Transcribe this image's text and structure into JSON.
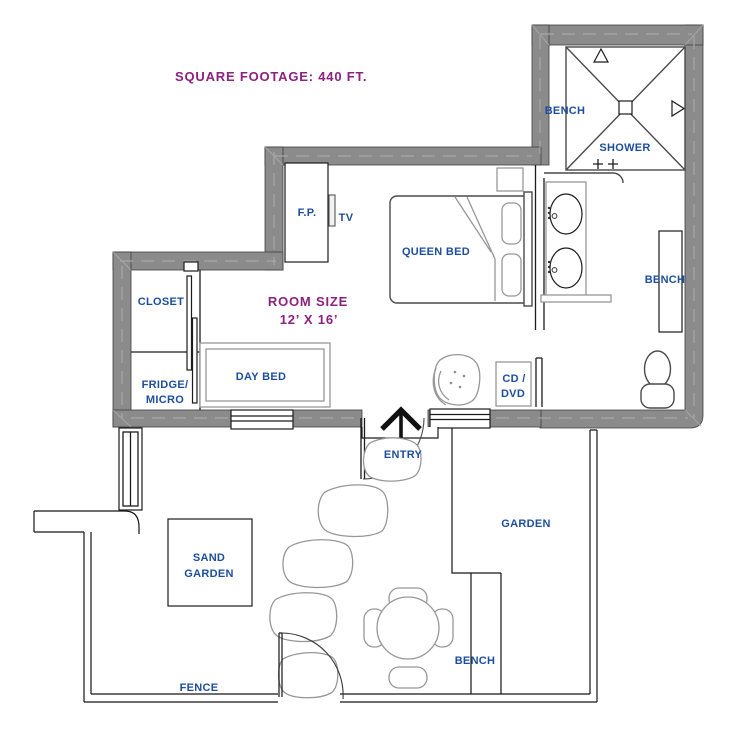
{
  "title": "Studio floor plan",
  "colors": {
    "label_blue": "#1d4e9d",
    "header_purple": "#8c2180",
    "wall_gray": "#8b8b8b",
    "wall_dash": "#ababab",
    "furniture_gray": "#979797",
    "line_black": "#1c1c1c"
  },
  "labels": {
    "square_footage": "SQUARE FOOTAGE:  440 FT.",
    "room_size_1": "ROOM SIZE",
    "room_size_2": "12’ X 16’",
    "bench_shower": "BENCH",
    "shower": "SHOWER",
    "fireplace": "F.P.",
    "tv": "TV",
    "queen_bed": "QUEEN BED",
    "closet": "CLOSET",
    "day_bed": "DAY BED",
    "fridge_1": "FRIDGE/",
    "fridge_2": "MICRO",
    "cd_1": "CD /",
    "cd_2": "DVD",
    "bench_bath": "BENCH",
    "entry": "ENTRY",
    "garden": "GARDEN",
    "sand_garden_1": "SAND",
    "sand_garden_2": "GARDEN",
    "bench_garden": "BENCH",
    "fence": "FENCE"
  }
}
